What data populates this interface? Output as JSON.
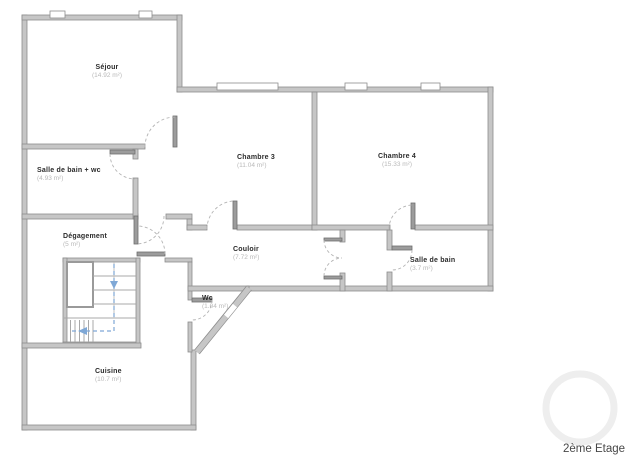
{
  "floor_plan": {
    "floor_label": "2ème Etage",
    "rooms": {
      "sejour": {
        "name": "Séjour",
        "area": "(14.92 m²)"
      },
      "sdb_wc": {
        "name": "Salle de bain + wc",
        "area": "(4.93 m²)"
      },
      "chambre3": {
        "name": "Chambre 3",
        "area": "(11.04 m²)"
      },
      "chambre4": {
        "name": "Chambre 4",
        "area": "(15.33 m²)"
      },
      "degagement": {
        "name": "Dégagement",
        "area": "(5 m²)"
      },
      "couloir": {
        "name": "Couloir",
        "area": "(7.72 m²)"
      },
      "salle_de_bain": {
        "name": "Salle de bain",
        "area": "(3.7 m²)"
      },
      "wc": {
        "name": "Wc",
        "area": "(1.04 m²)"
      },
      "cuisine": {
        "name": "Cuisine",
        "area": "(10.7 m²)"
      }
    },
    "colors": {
      "wall_fill": "#c6c6c6",
      "wall_border": "#8d8d8d",
      "stair_arrow_blue": "#7fa8d6",
      "room_name_text": "#2b2b2b",
      "room_area_text": "#b9b9b9"
    }
  }
}
